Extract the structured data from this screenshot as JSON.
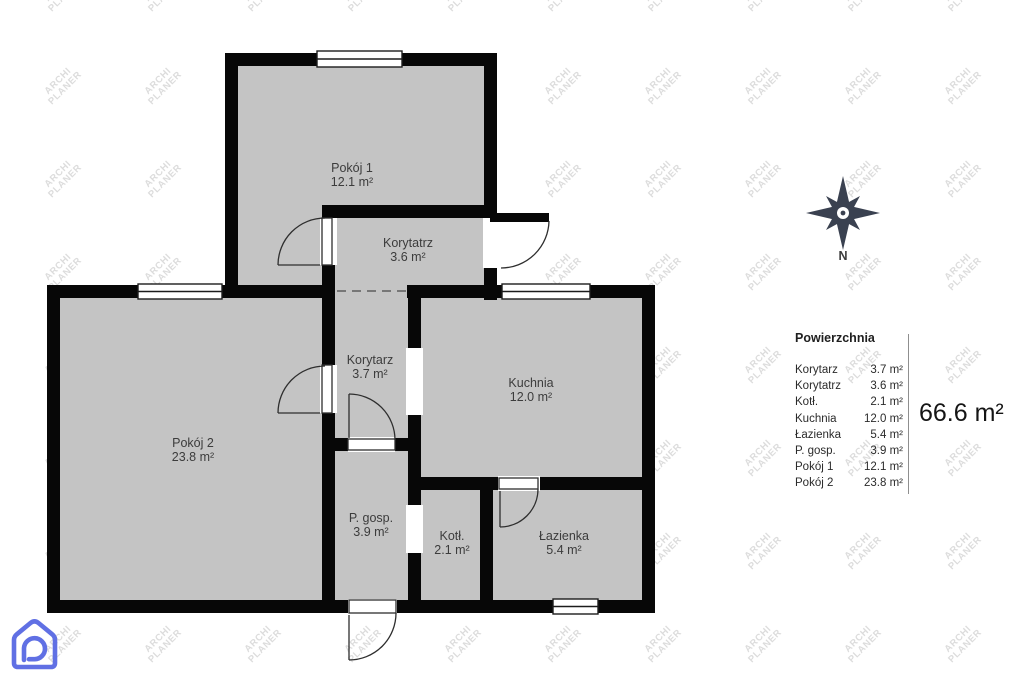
{
  "watermark": {
    "line1": "ARCHI",
    "line2": "PLANER"
  },
  "compass": {
    "north_label": "N"
  },
  "rooms": [
    {
      "id": "pokoj-1",
      "name": "Pokój 1",
      "area": "12.1 m²"
    },
    {
      "id": "korytatrz",
      "name": "Korytatrz",
      "area": "3.6 m²"
    },
    {
      "id": "korytarz",
      "name": "Korytarz",
      "area": "3.7 m²"
    },
    {
      "id": "kuchnia",
      "name": "Kuchnia",
      "area": "12.0 m²"
    },
    {
      "id": "pokoj-2",
      "name": "Pokój 2",
      "area": "23.8 m²"
    },
    {
      "id": "p-gosp",
      "name": "P. gosp.",
      "area": "3.9 m²"
    },
    {
      "id": "kotl",
      "name": "Kotł.",
      "area": "2.1 m²"
    },
    {
      "id": "lazienka",
      "name": "Łazienka",
      "area": "5.4 m²"
    }
  ],
  "legend": {
    "title": "Powierzchnia",
    "rows": [
      {
        "label": "Korytarz",
        "value": "3.7 m²"
      },
      {
        "label": "Korytatrz",
        "value": "3.6 m²"
      },
      {
        "label": "Kotł.",
        "value": "2.1 m²"
      },
      {
        "label": "Kuchnia",
        "value": "12.0 m²"
      },
      {
        "label": "Łazienka",
        "value": "5.4 m²"
      },
      {
        "label": "P. gosp.",
        "value": "3.9 m²"
      },
      {
        "label": "Pokój 1",
        "value": "12.1 m²"
      },
      {
        "label": "Pokój 2",
        "value": "23.8 m²"
      }
    ],
    "total": "66.6 m²"
  },
  "colors": {
    "wall": "#070707",
    "floor": "#c4c4c4",
    "watermark": "#dcdcdc",
    "compass": "#3a4150",
    "logo_accent": "#6070e4",
    "label_text": "#3c3c3c"
  }
}
